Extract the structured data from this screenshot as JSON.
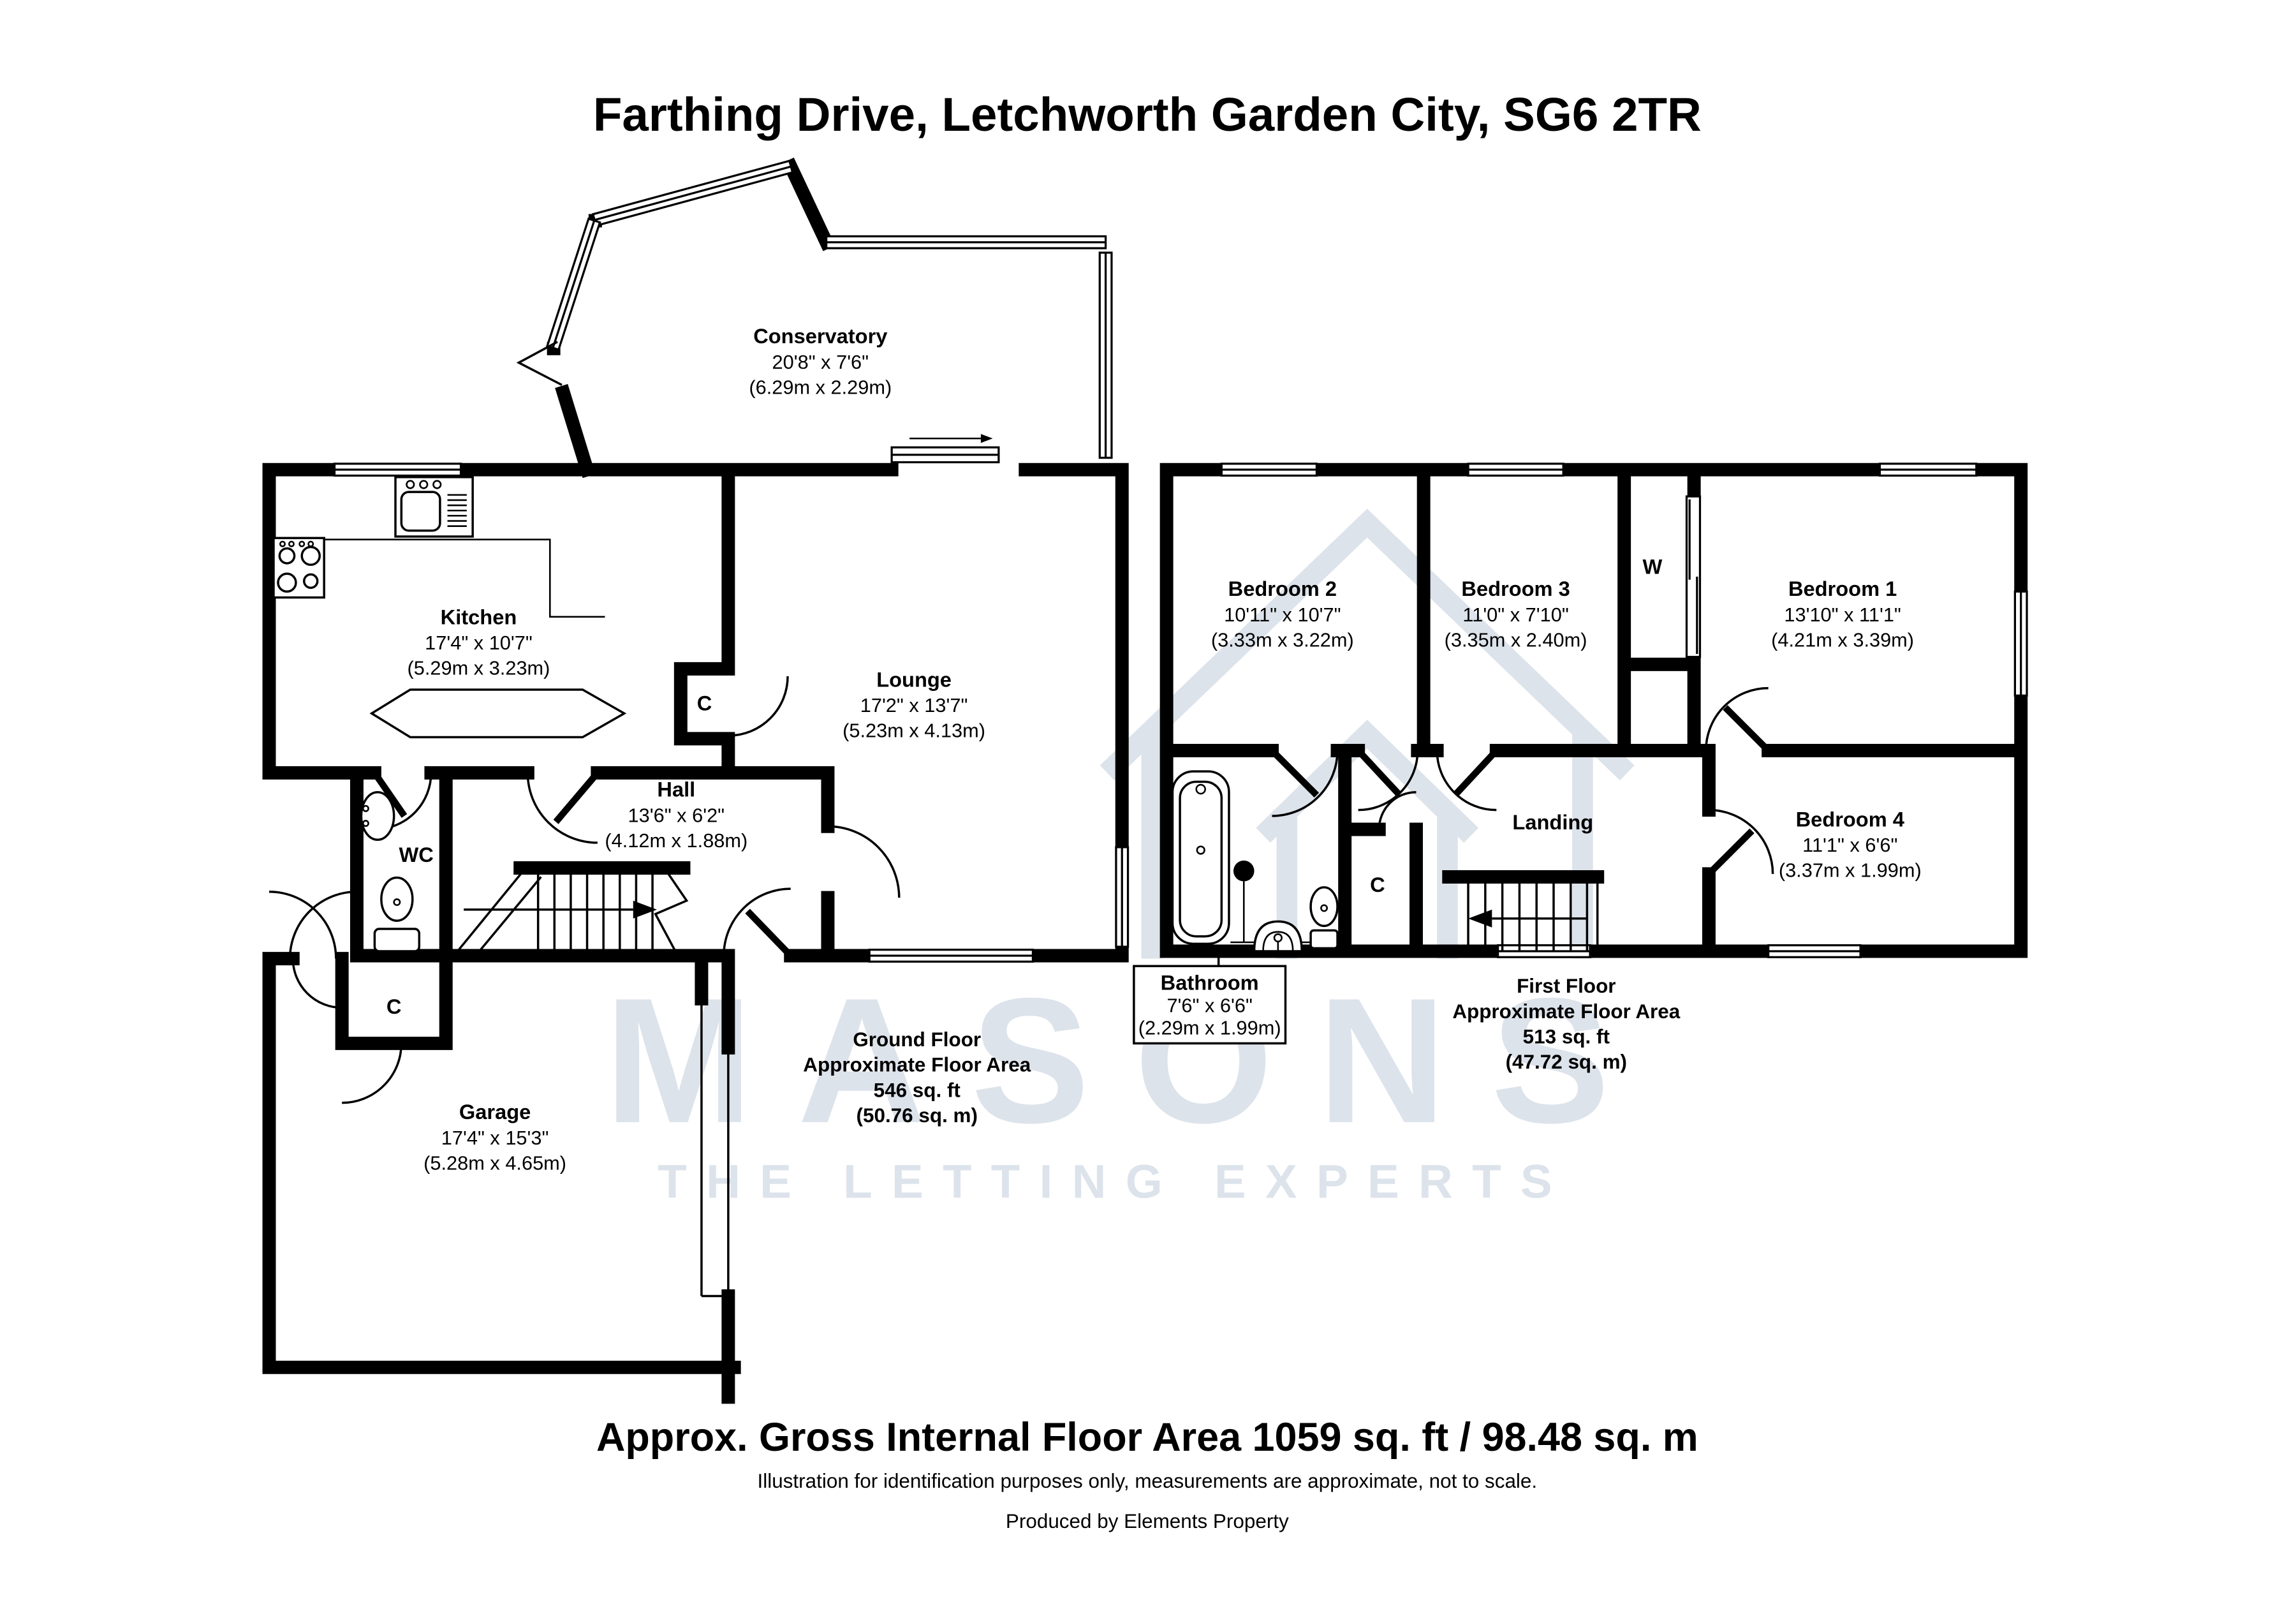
{
  "title": "Farthing Drive, Letchworth Garden City, SG6 2TR",
  "watermark": {
    "brand": "MASONS",
    "tagline": "THE LETTING EXPERTS",
    "color": "#dde3eb"
  },
  "ground_floor": {
    "rooms": {
      "conservatory": {
        "name": "Conservatory",
        "imperial": "20'8\" x 7'6\"",
        "metric": "(6.29m x 2.29m)"
      },
      "kitchen": {
        "name": "Kitchen",
        "imperial": "17'4\" x 10'7\"",
        "metric": "(5.29m x 3.23m)"
      },
      "lounge": {
        "name": "Lounge",
        "imperial": "17'2\" x 13'7\"",
        "metric": "(5.23m x 4.13m)"
      },
      "hall": {
        "name": "Hall",
        "imperial": "13'6\" x 6'2\"",
        "metric": "(4.12m x 1.88m)"
      },
      "garage": {
        "name": "Garage",
        "imperial": "17'4\" x 15'3\"",
        "metric": "(5.28m x 4.65m)"
      }
    },
    "labels": {
      "wc": "WC",
      "lounge_closet": "C",
      "entrance_closet": "C"
    },
    "summary": [
      "Ground Floor",
      "Approximate Floor Area",
      "546 sq. ft",
      "(50.76 sq. m)"
    ]
  },
  "first_floor": {
    "rooms": {
      "bedroom1": {
        "name": "Bedroom 1",
        "imperial": "13'10\" x 11'1\"",
        "metric": "(4.21m x 3.39m)"
      },
      "bedroom2": {
        "name": "Bedroom 2",
        "imperial": "10'11\" x 10'7\"",
        "metric": "(3.33m x 3.22m)"
      },
      "bedroom3": {
        "name": "Bedroom 3",
        "imperial": "11'0\" x 7'10\"",
        "metric": "(3.35m x 2.40m)"
      },
      "bedroom4": {
        "name": "Bedroom 4",
        "imperial": "11'1\" x 6'6\"",
        "metric": "(3.37m x 1.99m)"
      },
      "bathroom": {
        "name": "Bathroom",
        "imperial": "7'6\" x 6'6\"",
        "metric": "(2.29m x 1.99m)"
      }
    },
    "labels": {
      "landing": "Landing",
      "wardrobe": "W",
      "closet": "C"
    },
    "summary": [
      "First Floor",
      "Approximate Floor Area",
      "513 sq. ft",
      "(47.72 sq. m)"
    ]
  },
  "footer": {
    "area_line": "Approx. Gross Internal Floor Area 1059 sq. ft / 98.48 sq. m",
    "disclaimer": "Illustration for identification purposes only, measurements are approximate, not to scale.",
    "produced_by": "Produced by Elements Property"
  }
}
